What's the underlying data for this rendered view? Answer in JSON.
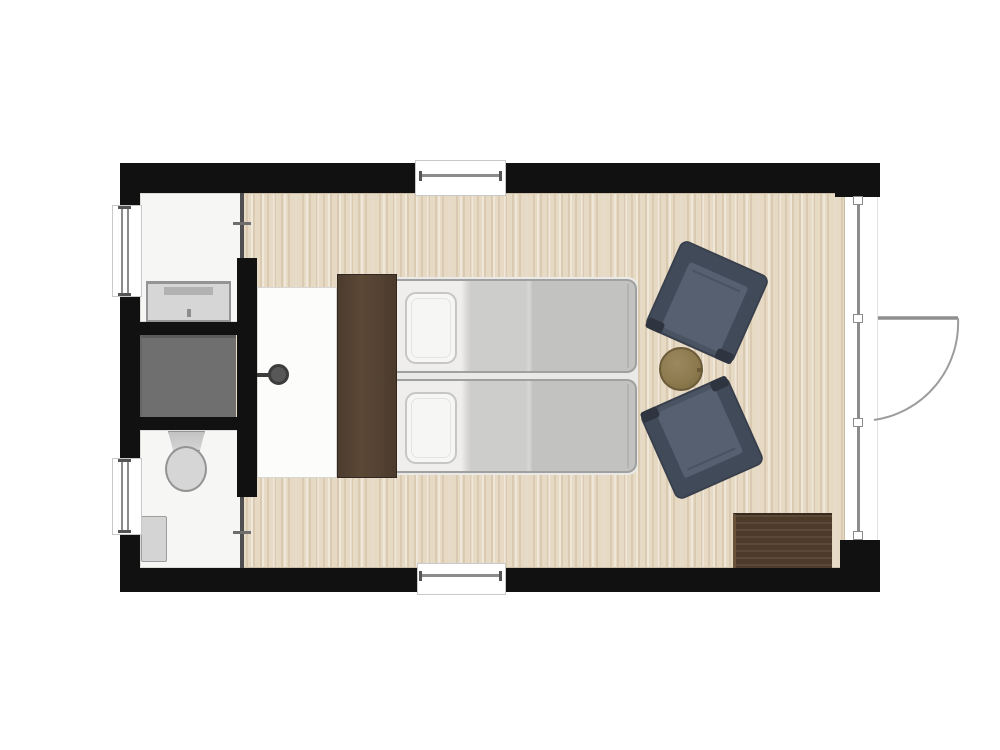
{
  "diagram": {
    "type": "architectural floor plan",
    "subject": "studio cabin with twin beds and en-suite bathroom",
    "rooms": [
      {
        "name": "main room",
        "floor": "light wood planks",
        "contents": [
          "dark wood headboard",
          "twin bed upper",
          "twin bed lower",
          "white bedside rug",
          "armchair upper",
          "armchair lower",
          "round side table",
          "dark wood door mat"
        ]
      },
      {
        "name": "washbasin room",
        "floor": "white",
        "contents": [
          "washbasin with faucet and drain"
        ]
      },
      {
        "name": "shower stall",
        "floor": "dark grey",
        "contents": []
      },
      {
        "name": "wc room",
        "floor": "white",
        "contents": [
          "toilet with tank",
          "low cabinet"
        ]
      }
    ],
    "openings": {
      "windows": [
        "top wall window",
        "bottom wall window",
        "left wall upper window",
        "left wall lower window"
      ],
      "glass_facade": "right wall floor-to-ceiling glazing with panel joints",
      "entry_door": "hinged door in right glass wall, swinging outward with quarter-circle arc",
      "interior_partitions": [
        "thin partition at washroom entry",
        "thin partition at wc entry"
      ]
    },
    "fixtures": [
      "round wall-mounted knob on bedroom side of shower wall"
    ]
  },
  "colors": {
    "wall": "#111111",
    "room-white": "#f6f6f5",
    "floor-base": "#e7dac4",
    "shower": "#6f6f6f",
    "shower-edge": "#5c5c5c",
    "fixture-fill": "#d6d6d6",
    "fixture-edge": "#949494",
    "rug": "#fcfcfb",
    "knob": "#575757",
    "knob-dark": "#3c3c3c",
    "headboard": "#5b4836",
    "headboard-edge": "#332821",
    "bed-sheet": "#efeeec",
    "bed-mid": "#cdcdcb",
    "bed-blanket": "#c2c2c0",
    "bed-edge": "#a0a09e",
    "pillow": "#f6f6f4",
    "pillow-edge": "#c6c6c4",
    "chair-body": "#4a5361",
    "chair-cushion": "#566070",
    "chair-dark": "#2e3540",
    "chair-edge": "#39404d",
    "table": "#8d7a4e",
    "table-edge": "#6c5b38",
    "mat": "#4d3a29",
    "mat-light": "#6b5339",
    "glass": "#8c8c8c",
    "frame-edge": "#c9c9c9",
    "partition": "#4f4f4f",
    "tick": "#6e6e6e"
  }
}
